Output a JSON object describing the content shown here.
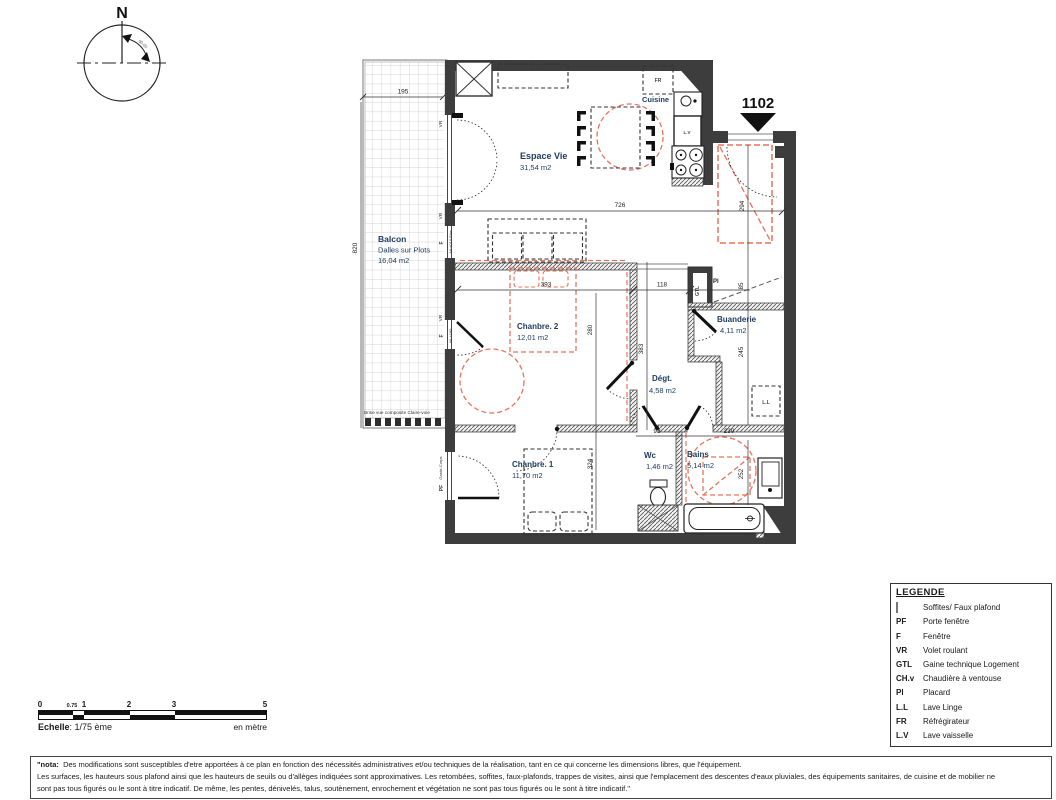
{
  "compass": {
    "north_label": "N",
    "bearing": "90.00"
  },
  "unit_number": "1102",
  "rooms": {
    "balcon": {
      "name": "Balcon",
      "type": "Dalles sur Plots",
      "area": "16,04 m2",
      "note": "Brise vue composite Claire-voie"
    },
    "espace_vie": {
      "name": "Espace Vie",
      "area": "31,54 m2"
    },
    "cuisine": {
      "name": "Cuisine"
    },
    "chambre2": {
      "name": "Chanbre. 2",
      "area": "12,01 m2"
    },
    "buanderie": {
      "name": "Buanderie",
      "area": "4,11 m2"
    },
    "degagement": {
      "name": "Dégt.",
      "area": "4,58 m2"
    },
    "chambre1": {
      "name": "Chanbre. 1",
      "area": "11,70 m2"
    },
    "wc": {
      "name": "Wc",
      "area": "1,46 m2"
    },
    "bains": {
      "name": "Bains",
      "area": "5,14 m2"
    }
  },
  "dimensions": {
    "d195": "195",
    "d820": "820",
    "d726": "726",
    "d294": "294",
    "d393": "393",
    "d118": "118",
    "d280": "280",
    "d383": "383",
    "d85": "85",
    "d245": "245",
    "d230": "230",
    "d93": "93",
    "d324": "324",
    "d252": "252"
  },
  "wall_labels": {
    "vr": "VR",
    "f": "F",
    "pf": "PF",
    "alt010": "Alt +010 Fixe",
    "alt180": "Alt +180",
    "garde_corps": "Garde-Corps"
  },
  "appliances": {
    "fr": "FR",
    "lv": "L.V",
    "ll": "L.L",
    "gtl": "GTL",
    "pl": "Pl"
  },
  "legend": {
    "title": "LEGENDE",
    "items": [
      {
        "key": "",
        "label": "Soffites/ Faux plafond"
      },
      {
        "key": "PF",
        "label": "Porte fenêtre"
      },
      {
        "key": "F",
        "label": "Fenêtre"
      },
      {
        "key": "VR",
        "label": "Volet roulant"
      },
      {
        "key": "GTL",
        "label": "Gaine technique Logement"
      },
      {
        "key": "CH.v",
        "label": "Chaudière à ventouse"
      },
      {
        "key": "Pl",
        "label": "Placard"
      },
      {
        "key": "L.L",
        "label": "Lave Linge"
      },
      {
        "key": "FR",
        "label": "Réfrégirateur"
      },
      {
        "key": "L.V",
        "label": "Lave vaisselle"
      }
    ]
  },
  "scale_bar": {
    "ticks": [
      "0",
      "0.75",
      "1",
      "2",
      "3",
      "5"
    ],
    "label": "Echelle",
    "ratio": ": 1/75 ème",
    "unit": "en mètre"
  },
  "nota": {
    "prefix": "\"nota:",
    "line1": "Des modifications sont susceptibles d'etre apportées à ce plan en fonction des nécessités administratives et/ou techniques de la réalisation, tant en ce qui concerne les dimensions libres, que l'équipement.",
    "line2": "Les surfaces, les hauteurs sous plafond ainsi que les hauteurs de seuils ou d'allèges indiquées sont approximatives. Les retombées, soffites, faux-plafonds, trappes de visites, ainsi que l'emplacement des descentes d'eaux pluviales, des équipements sanitaires, de cuisine et de mobilier ne",
    "line3": "sont pas tous figurés ou le sont à titre indicatif. De même, les pentes, dénivelés, talus, soutènement, enrochement et végétation ne sont pas tous  figurés ou le sont à titre indicatif.\""
  },
  "colors": {
    "wall": "#3d3d3d",
    "accent_red": "#e8735c",
    "room_label": "#1b3a5e",
    "soffite_swatch": "#d9d9d9"
  }
}
